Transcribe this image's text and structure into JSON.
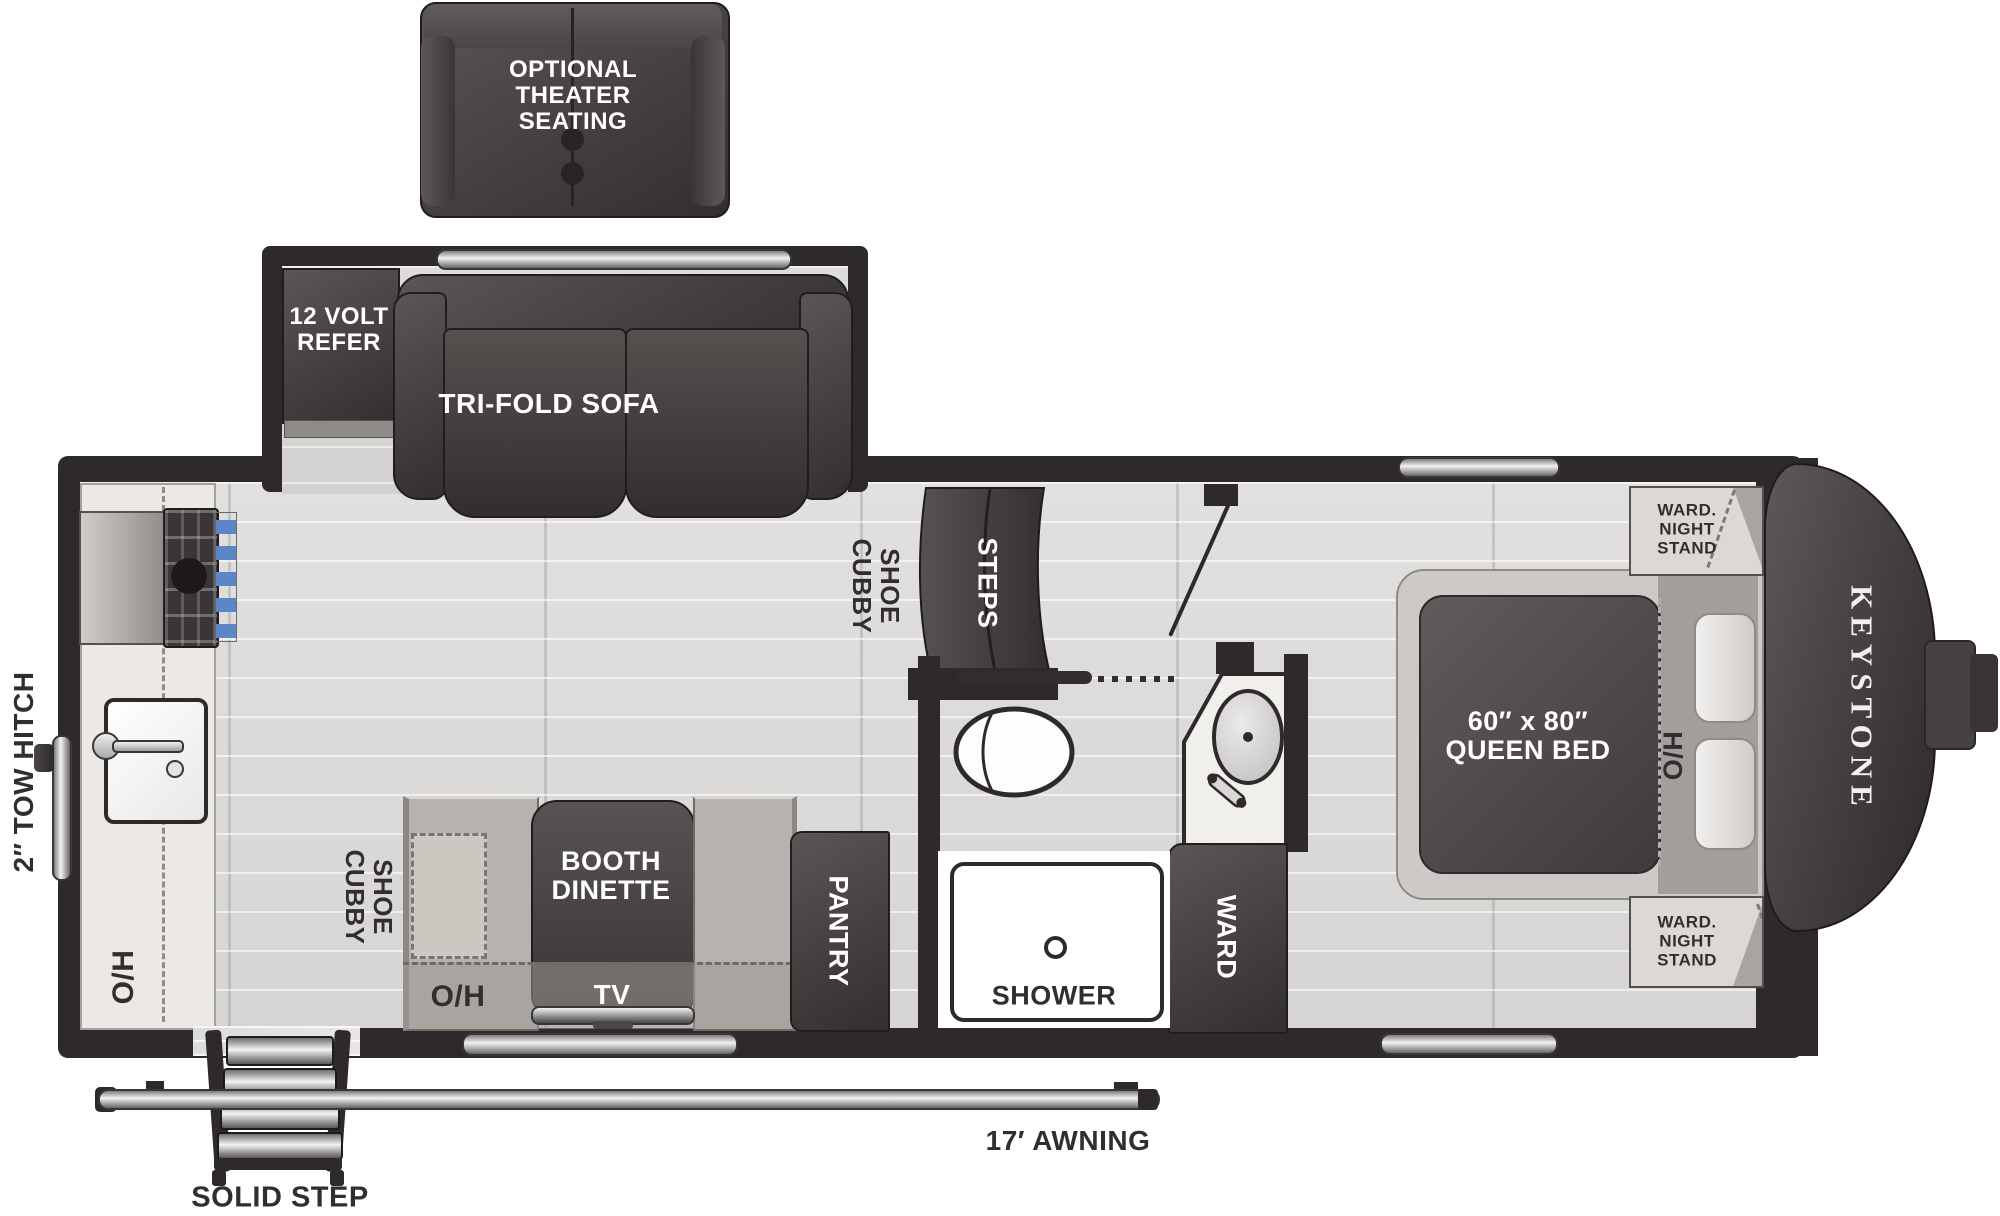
{
  "brand": {
    "name": "KEYSTONE"
  },
  "colors": {
    "wall": "#2e2a2b",
    "floor": "#dbdad8",
    "furniture_dark": "#453f40",
    "counter": "#ece9e4",
    "bench": "#b6b2af",
    "window_silver": "#d9d9d9",
    "knob_blue": "#5c86c8",
    "label_dark": "#322e2f",
    "label_white": "#ffffff"
  },
  "exterior": {
    "theater_seating_label": "OPTIONAL\nTHEATER\nSEATING",
    "tow_hitch_label": "2″ TOW HITCH",
    "solid_step_label": "SOLID STEP",
    "awning_label": "17′ AWNING"
  },
  "slideout": {
    "refer_label": "12 VOLT\nREFER",
    "sofa_label": "TRI-FOLD SOFA"
  },
  "kitchen": {
    "overhead_label": "O/H"
  },
  "living": {
    "shoe_cubby_entry_label": "SHOE\nCUBBY",
    "steps_label": "STEPS",
    "shoe_cubby_dinette_label": "SHOE\nCUBBY",
    "booth_dinette_label": "BOOTH\nDINETTE",
    "tv_label": "TV",
    "overhead_label": "O/H",
    "pantry_label": "PANTRY"
  },
  "bathroom": {
    "shower_label": "SHOWER",
    "wardrobe_label": "WARD"
  },
  "bedroom": {
    "queen_bed_label": "60″ x 80″\nQUEEN BED",
    "headboard_overhead_label": "H/O",
    "nightstand_front_label": "WARD.\nNIGHT\nSTAND",
    "nightstand_rear_label": "WARD.\nNIGHT\nSTAND"
  }
}
